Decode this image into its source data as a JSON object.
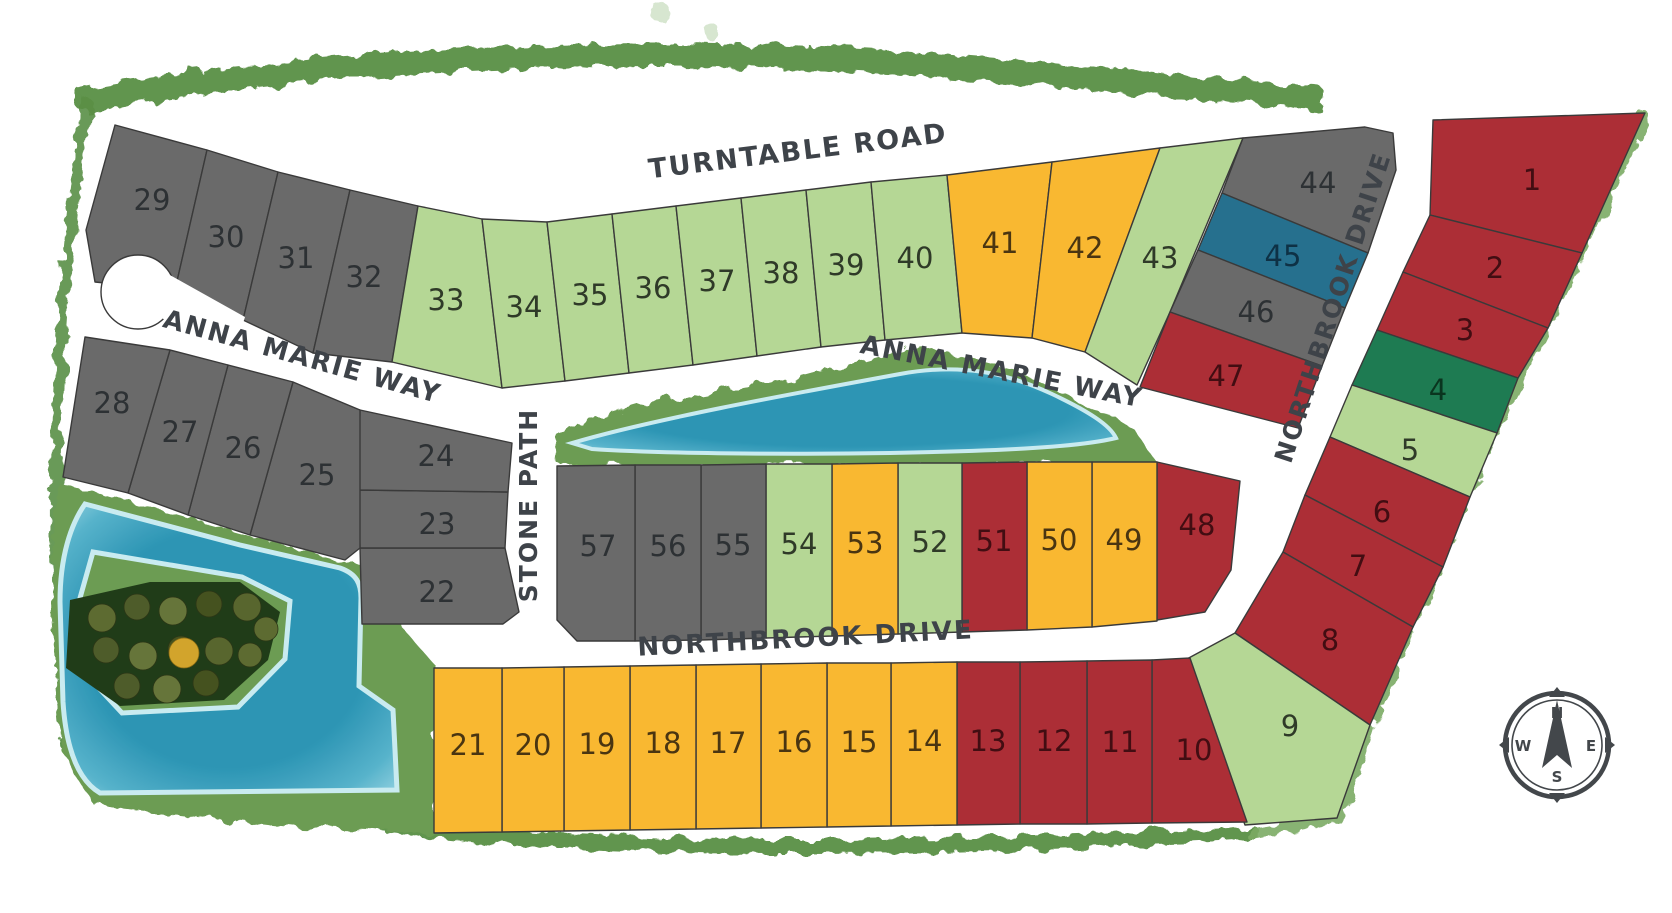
{
  "title": "Residential lot site plan",
  "streets": [
    {
      "id": "turntable-road",
      "label": "TURNTABLE ROAD"
    },
    {
      "id": "anna-marie-way-west",
      "label": "ANNA MARIE WAY"
    },
    {
      "id": "anna-marie-way-east",
      "label": "ANNA MARIE WAY"
    },
    {
      "id": "northbrook-drive-east",
      "label": "NORTHBROOK DRIVE"
    },
    {
      "id": "northbrook-drive-south",
      "label": "NORTHBROOK DRIVE"
    },
    {
      "id": "stone-path",
      "label": "STONE PATH"
    }
  ],
  "compass": {
    "north": "N",
    "east": "E",
    "south": "S",
    "west": "W"
  },
  "status_colors": {
    "gray": "#6a6a6a",
    "light_green": "#b5d795",
    "yellow": "#f9b831",
    "red": "#ac2e36",
    "teal": "#26708e",
    "dark_green": "#1e7b52"
  },
  "number_colors": {
    "gray": "#2d3134",
    "light_green": "#2f3a28",
    "yellow": "#4a3511",
    "red": "#420d12",
    "teal": "#0e3145",
    "dark_green": "#0a351f"
  },
  "terrain_colors": {
    "grass": "#6c9c52",
    "perimeter_band": "#5a8f45",
    "perimeter_band_light": "#7cab64",
    "water_deep": "#2b95b8",
    "water_mid": "#57b4cf",
    "water_light": "#a9dfee",
    "water_rim": "#cdeef6",
    "island": "#203c18",
    "tree_yellow": "#d2a42c",
    "outline": "#3a3a3a"
  },
  "lots": [
    {
      "number": "1",
      "status": "red"
    },
    {
      "number": "2",
      "status": "red"
    },
    {
      "number": "3",
      "status": "red"
    },
    {
      "number": "4",
      "status": "dark_green"
    },
    {
      "number": "5",
      "status": "light_green"
    },
    {
      "number": "6",
      "status": "red"
    },
    {
      "number": "7",
      "status": "red"
    },
    {
      "number": "8",
      "status": "red"
    },
    {
      "number": "9",
      "status": "light_green"
    },
    {
      "number": "10",
      "status": "red"
    },
    {
      "number": "11",
      "status": "red"
    },
    {
      "number": "12",
      "status": "red"
    },
    {
      "number": "13",
      "status": "red"
    },
    {
      "number": "14",
      "status": "yellow"
    },
    {
      "number": "15",
      "status": "yellow"
    },
    {
      "number": "16",
      "status": "yellow"
    },
    {
      "number": "17",
      "status": "yellow"
    },
    {
      "number": "18",
      "status": "yellow"
    },
    {
      "number": "19",
      "status": "yellow"
    },
    {
      "number": "20",
      "status": "yellow"
    },
    {
      "number": "21",
      "status": "yellow"
    },
    {
      "number": "22",
      "status": "gray"
    },
    {
      "number": "23",
      "status": "gray"
    },
    {
      "number": "24",
      "status": "gray"
    },
    {
      "number": "25",
      "status": "gray"
    },
    {
      "number": "26",
      "status": "gray"
    },
    {
      "number": "27",
      "status": "gray"
    },
    {
      "number": "28",
      "status": "gray"
    },
    {
      "number": "29",
      "status": "gray"
    },
    {
      "number": "30",
      "status": "gray"
    },
    {
      "number": "31",
      "status": "gray"
    },
    {
      "number": "32",
      "status": "gray"
    },
    {
      "number": "33",
      "status": "light_green"
    },
    {
      "number": "34",
      "status": "light_green"
    },
    {
      "number": "35",
      "status": "light_green"
    },
    {
      "number": "36",
      "status": "light_green"
    },
    {
      "number": "37",
      "status": "light_green"
    },
    {
      "number": "38",
      "status": "light_green"
    },
    {
      "number": "39",
      "status": "light_green"
    },
    {
      "number": "40",
      "status": "light_green"
    },
    {
      "number": "41",
      "status": "yellow"
    },
    {
      "number": "42",
      "status": "yellow"
    },
    {
      "number": "43",
      "status": "light_green"
    },
    {
      "number": "44",
      "status": "gray"
    },
    {
      "number": "45",
      "status": "teal"
    },
    {
      "number": "46",
      "status": "gray"
    },
    {
      "number": "47",
      "status": "red"
    },
    {
      "number": "48",
      "status": "red"
    },
    {
      "number": "49",
      "status": "yellow"
    },
    {
      "number": "50",
      "status": "yellow"
    },
    {
      "number": "51",
      "status": "red"
    },
    {
      "number": "52",
      "status": "light_green"
    },
    {
      "number": "53",
      "status": "yellow"
    },
    {
      "number": "54",
      "status": "light_green"
    },
    {
      "number": "55",
      "status": "gray"
    },
    {
      "number": "56",
      "status": "gray"
    },
    {
      "number": "57",
      "status": "gray"
    }
  ]
}
